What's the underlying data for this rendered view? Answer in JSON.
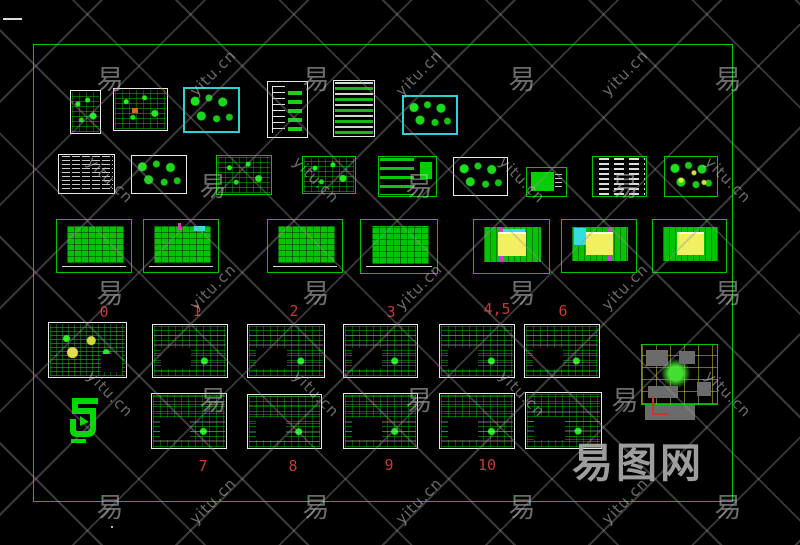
{
  "canvas": {
    "background": "#000000",
    "frame_border_color": "#00c400"
  },
  "palette": {
    "cad_green": "#00d400",
    "cad_white": "#e9e9e9",
    "cad_cyan": "#2ad4d4",
    "cad_yellow": "#f0f060",
    "cad_magenta": "#cf3ecf",
    "label_red": "#c23b3b",
    "site_gray": "#6b6b6b",
    "watermark_gray": "#9a9a9a"
  },
  "labels": {
    "row4": [
      "0",
      "1",
      "2",
      "3",
      "4,5",
      "6"
    ],
    "row5": [
      "7",
      "8",
      "9",
      "10"
    ]
  },
  "watermark": {
    "glyph": "易",
    "site_text": "yitu.cn",
    "logo_text": "易图网",
    "rows": 5,
    "cols": 7,
    "x_start": 110,
    "x_step": 103,
    "y_start": 58,
    "y_step": 107
  },
  "thumbnails": [
    {
      "id": "r1a",
      "border": "white"
    },
    {
      "id": "r1b",
      "border": "white"
    },
    {
      "id": "r1c",
      "border": "cyan"
    },
    {
      "id": "r1d",
      "border": "white"
    },
    {
      "id": "r1e",
      "border": "white"
    },
    {
      "id": "r1f",
      "border": "cyan"
    },
    {
      "id": "r2a",
      "border": "white"
    },
    {
      "id": "r2b",
      "border": "white"
    },
    {
      "id": "r2c",
      "border": "green"
    },
    {
      "id": "r2d",
      "border": "green"
    },
    {
      "id": "r2e",
      "border": "green"
    },
    {
      "id": "r2f",
      "border": "white"
    },
    {
      "id": "r2g",
      "border": "green"
    },
    {
      "id": "r2h",
      "border": "green"
    },
    {
      "id": "r2i",
      "border": "green"
    },
    {
      "id": "r3a",
      "border": "green"
    },
    {
      "id": "r3b",
      "border": "green"
    },
    {
      "id": "r3c",
      "border": "green"
    },
    {
      "id": "r3d",
      "border": "green"
    },
    {
      "id": "r3e",
      "border": "green"
    },
    {
      "id": "r3f",
      "border": "green"
    },
    {
      "id": "r3g",
      "border": "green"
    },
    {
      "id": "r4a",
      "border": "white"
    },
    {
      "id": "r4b",
      "border": "white"
    },
    {
      "id": "r4c",
      "border": "white"
    },
    {
      "id": "r4d",
      "border": "white"
    },
    {
      "id": "r4e",
      "border": "white"
    },
    {
      "id": "r4f",
      "border": "white"
    },
    {
      "id": "site",
      "border": "green"
    },
    {
      "id": "r5a",
      "border": "white"
    },
    {
      "id": "r5b",
      "border": "white"
    },
    {
      "id": "r5c",
      "border": "white"
    },
    {
      "id": "r5d",
      "border": "white"
    },
    {
      "id": "r5e",
      "border": "white"
    }
  ]
}
